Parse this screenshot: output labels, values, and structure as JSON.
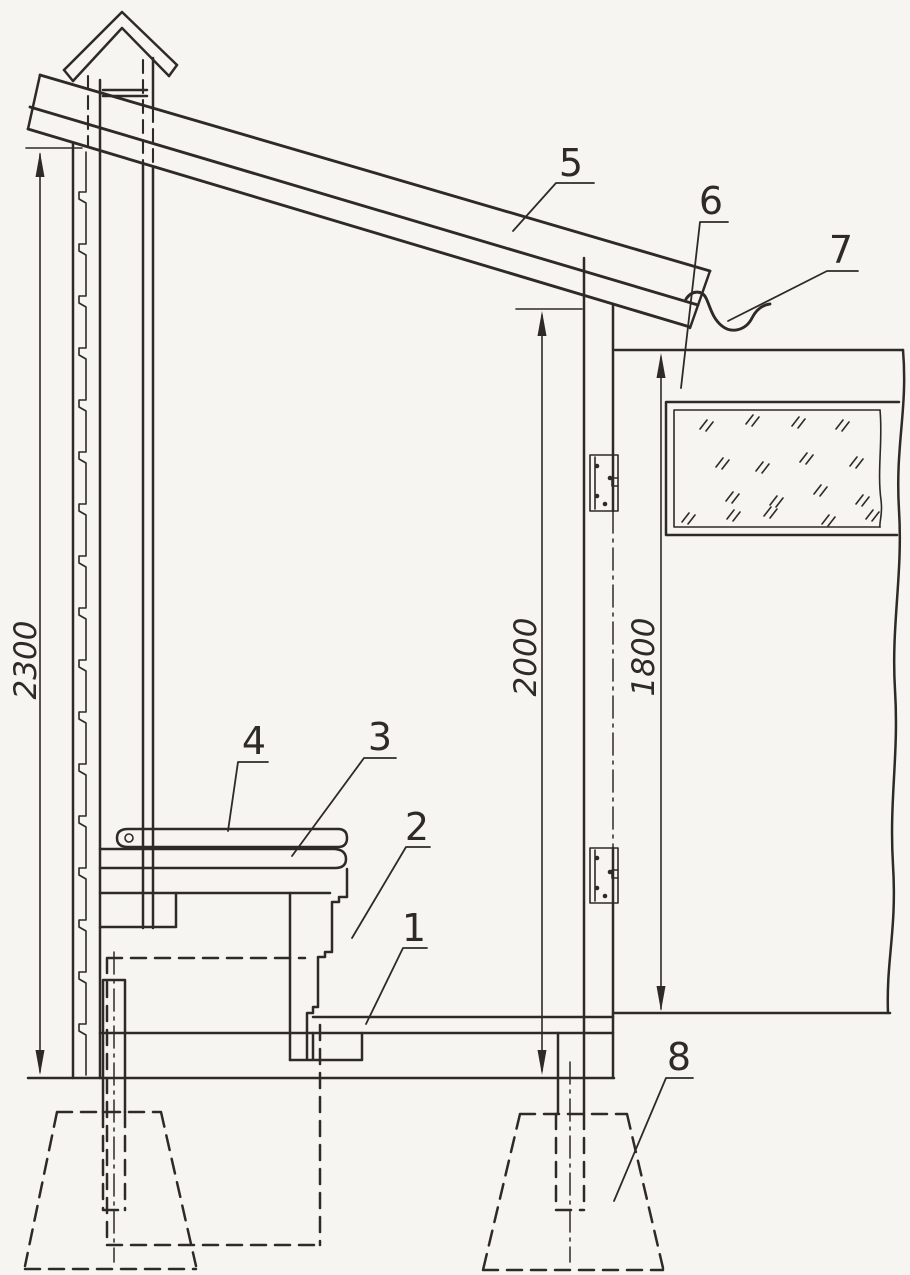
{
  "drawing": {
    "type": "sectional technical drawing of an outhouse (privy) structure",
    "colors": {
      "ink": "#2e2b26",
      "paper": "#f6f5f1"
    },
    "dimensions": {
      "back_wall_height": "2300",
      "interior_height": "2000",
      "door_height": "1800"
    },
    "part_labels": {
      "floor": "1",
      "riser": "2",
      "seat": "3",
      "lid": "4",
      "roof": "5",
      "door": "6",
      "drip_edge": "7",
      "footing": "8"
    }
  }
}
